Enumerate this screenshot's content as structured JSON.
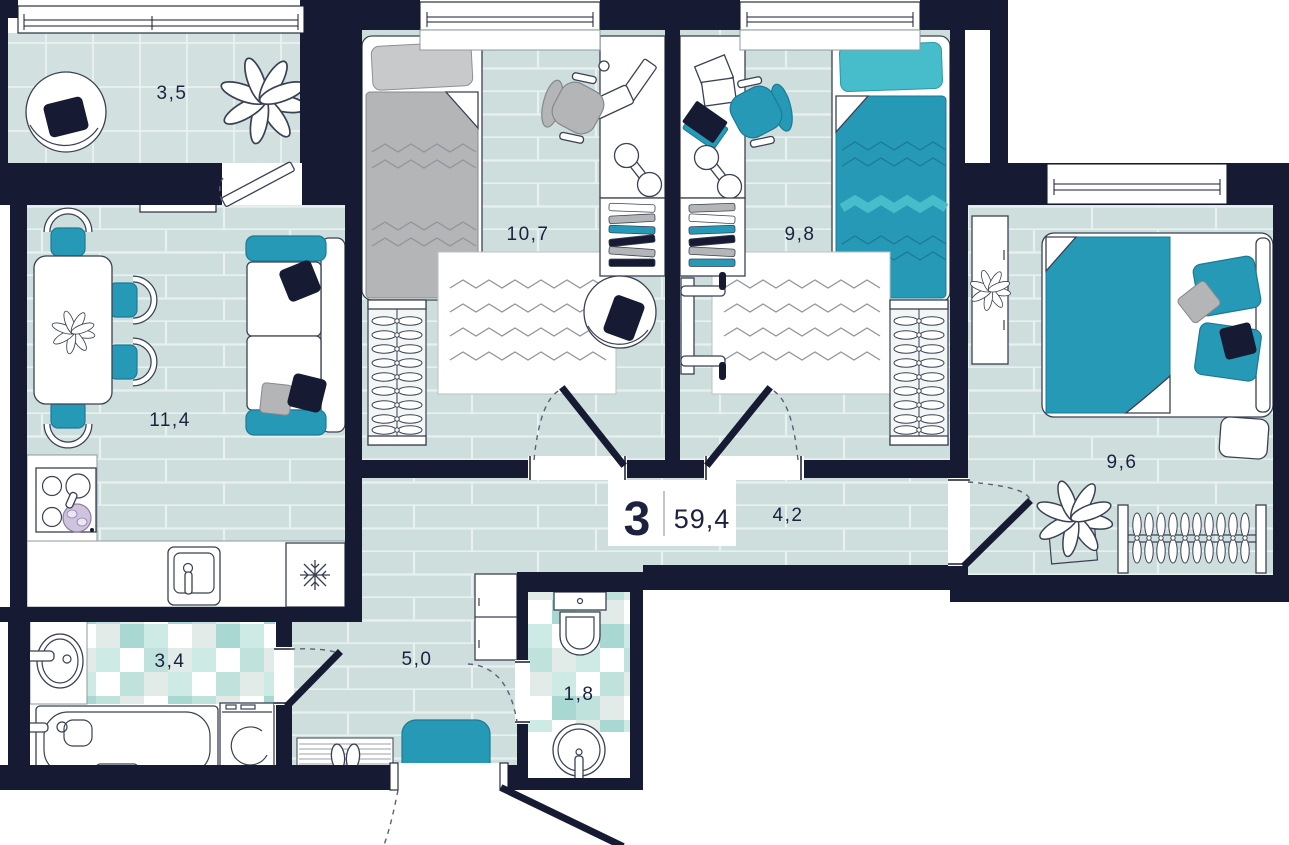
{
  "title": "3-room apartment floor plan",
  "summary": {
    "rooms_count": "3",
    "total_area": "59,4"
  },
  "rooms": {
    "balcony": {
      "area": "3,5",
      "furniture": [
        "lounge-chair",
        "plant"
      ]
    },
    "living_kitchen": {
      "area": "11,4",
      "furniture": [
        "dining-table",
        "chairs",
        "sofa",
        "stove",
        "kitchen-sink",
        "fridge",
        "radiator"
      ]
    },
    "bedroom_1": {
      "area": "10,7",
      "furniture": [
        "single-bed-gray",
        "desk-computer",
        "office-chair",
        "bookshelf",
        "dumbbell",
        "wardrobe-rack",
        "rug",
        "round-chair"
      ]
    },
    "bedroom_2": {
      "area": "9,8",
      "furniture": [
        "single-bed-teal",
        "desk-papers",
        "office-chair",
        "bookshelf",
        "dumbbell",
        "wardrobe-rack",
        "rug",
        "bench"
      ]
    },
    "bedroom_3": {
      "area": "9,6",
      "furniture": [
        "double-bed",
        "dresser",
        "plant-on-dresser",
        "floor-plant",
        "clothes-rail",
        "bench"
      ]
    },
    "corridor": {
      "area": "4,2",
      "furniture": []
    },
    "hallway": {
      "area": "5,0",
      "furniture": [
        "shoe-cabinet",
        "teal-mat",
        "doormat-with-shoes"
      ]
    },
    "bathroom": {
      "area": "3,4",
      "furniture": [
        "round-sink",
        "bathtub",
        "washing-machine"
      ]
    },
    "wc": {
      "area": "1,8",
      "furniture": [
        "toilet",
        "round-sink"
      ]
    }
  },
  "colors": {
    "wall": "#161b33",
    "floor": "#cddedd",
    "accent": "#2699b7",
    "accent_light": "#47bcca",
    "gray": "#b3b5b7"
  }
}
